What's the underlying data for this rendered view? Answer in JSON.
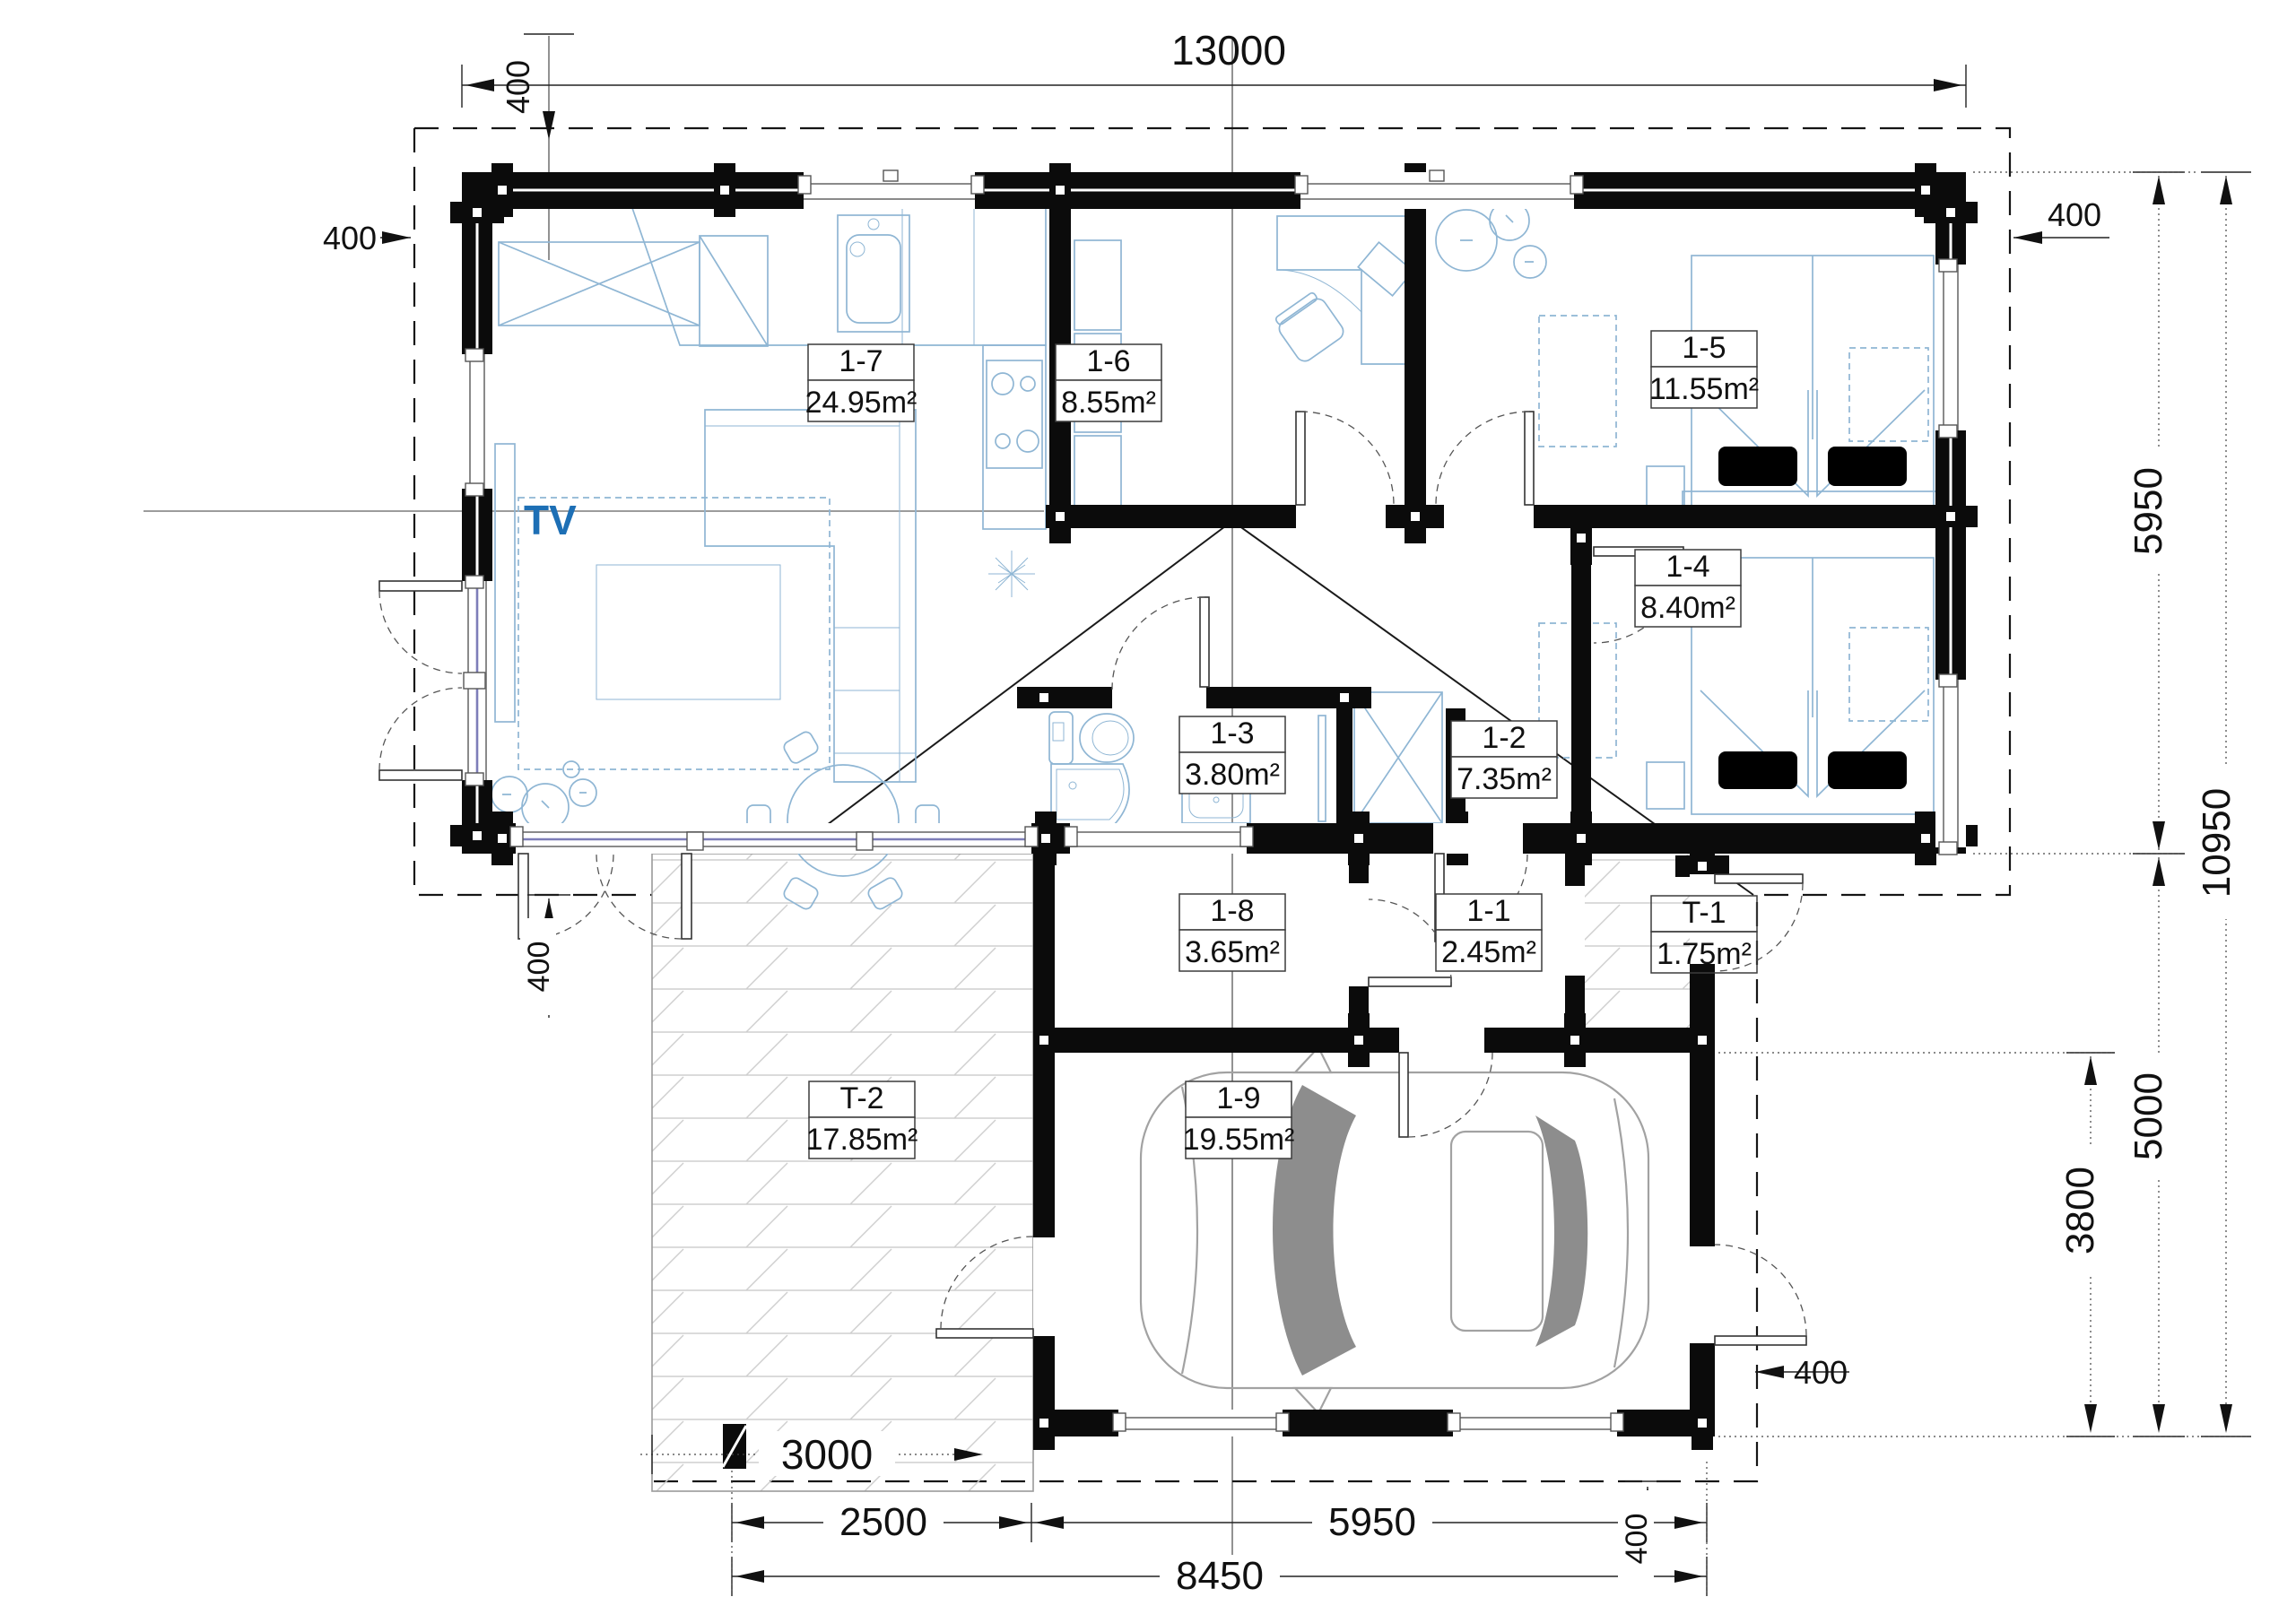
{
  "plan": {
    "labels": {
      "tv": "TV"
    },
    "rooms": [
      {
        "id": "1-7",
        "area": "24.95m²"
      },
      {
        "id": "1-6",
        "area": "8.55m²"
      },
      {
        "id": "1-5",
        "area": "11.55m²"
      },
      {
        "id": "1-4",
        "area": "8.40m²"
      },
      {
        "id": "1-3",
        "area": "3.80m²"
      },
      {
        "id": "1-2",
        "area": "7.35m²"
      },
      {
        "id": "1-8",
        "area": "3.65m²"
      },
      {
        "id": "1-1",
        "area": "2.45m²"
      },
      {
        "id": "T-1",
        "area": "1.75m²"
      },
      {
        "id": "T-2",
        "area": "17.85m²"
      },
      {
        "id": "1-9",
        "area": "19.55m²"
      }
    ],
    "dimensions": {
      "top_width": "13000",
      "eave_top": "400",
      "eave_left": "400",
      "eave_right": "400",
      "eave_bottom_left": "400",
      "eave_terrace": "400",
      "eave_garage": "400",
      "right_upper": "5950",
      "right_total": "10950",
      "right_lower": "5000",
      "garage_depth": "3800",
      "terrace_width": "3000",
      "bottom_left": "2500",
      "bottom_right": "5950",
      "bottom_total": "8450"
    }
  }
}
